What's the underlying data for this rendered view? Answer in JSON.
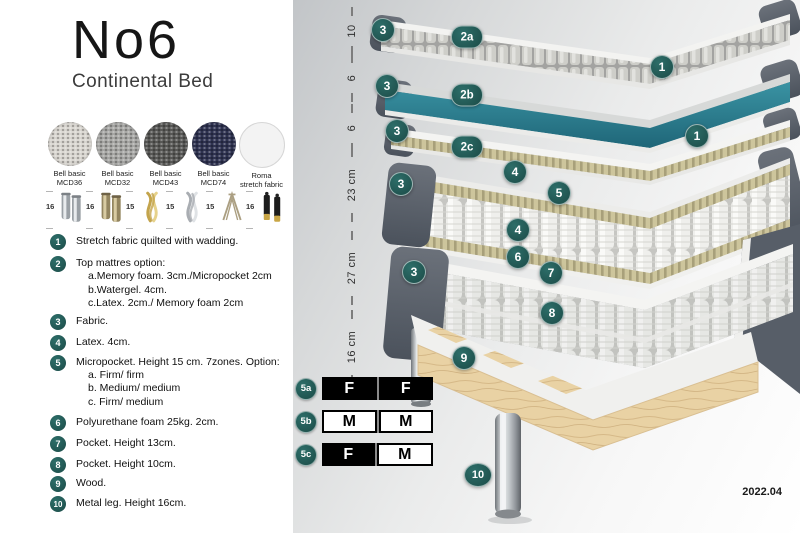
{
  "header": {
    "title": "No6",
    "subtitle": "Continental Bed"
  },
  "fabrics": [
    {
      "line1": "Bell basic",
      "line2": "MCD36",
      "color": "#d9d6d0",
      "texture": true
    },
    {
      "line1": "Bell basic",
      "line2": "MCD32",
      "color": "#a6a6a4",
      "texture": true
    },
    {
      "line1": "Bell basic",
      "line2": "MCD43",
      "color": "#585856",
      "texture": true
    },
    {
      "line1": "Bell basic",
      "line2": "MCD74",
      "color": "#2e3250",
      "texture": true
    },
    {
      "line1": "Roma",
      "line2": "stretch fabric",
      "color": "#f3f3f3",
      "texture": false
    }
  ],
  "legs": [
    {
      "size": "16",
      "icon": "cylinder-silver-leg"
    },
    {
      "size": "16",
      "icon": "cylinder-bronze-leg"
    },
    {
      "size": "15",
      "icon": "twisted-gold-leg"
    },
    {
      "size": "15",
      "icon": "twisted-silver-leg"
    },
    {
      "size": "15",
      "icon": "hairpin-leg"
    },
    {
      "size": "16",
      "icon": "black-gold-leg"
    }
  ],
  "features": [
    {
      "num": "1",
      "text": "Stretch fabric quilted with wadding.",
      "subs": []
    },
    {
      "num": "2",
      "text": "Top mattres option:",
      "subs": [
        "a.Memory foam. 3cm./Micropocket 2cm",
        "b.Watergel. 4cm.",
        "c.Latex. 2cm./ Memory foam 2cm"
      ]
    },
    {
      "num": "3",
      "text": "Fabric.",
      "subs": []
    },
    {
      "num": "4",
      "text": "Latex. 4cm.",
      "subs": []
    },
    {
      "num": "5",
      "text": "Micropocket. Height 15 cm. 7zones. Option:",
      "subs": [
        "a. Firm/ firm",
        "b. Medium/ medium",
        "c. Firm/ medium"
      ]
    },
    {
      "num": "6",
      "text": "Polyurethane foam 25kg. 2cm.",
      "subs": []
    },
    {
      "num": "7",
      "text": "Pocket. Height 13cm.",
      "subs": []
    },
    {
      "num": "8",
      "text": "Pocket. Height 10cm.",
      "subs": []
    },
    {
      "num": "9",
      "text": "Wood.",
      "subs": []
    },
    {
      "num": "10",
      "text": "Metal leg. Height 16cm.",
      "subs": []
    }
  ],
  "diagram": {
    "ruler": [
      {
        "label": "10",
        "y": 31
      },
      {
        "label": "6",
        "y": 78
      },
      {
        "label": "6",
        "y": 128
      },
      {
        "label": "23 cm",
        "y": 185
      },
      {
        "label": "27 cm",
        "y": 268
      },
      {
        "label": "16 cm",
        "y": 347
      }
    ],
    "badges": [
      {
        "label": "3",
        "x": 383,
        "y": 30
      },
      {
        "label": "2a",
        "x": 467,
        "y": 37
      },
      {
        "label": "1",
        "x": 662,
        "y": 67
      },
      {
        "label": "3",
        "x": 387,
        "y": 86
      },
      {
        "label": "2b",
        "x": 467,
        "y": 95
      },
      {
        "label": "3",
        "x": 397,
        "y": 131
      },
      {
        "label": "2c",
        "x": 467,
        "y": 147
      },
      {
        "label": "1",
        "x": 697,
        "y": 136
      },
      {
        "label": "4",
        "x": 515,
        "y": 172
      },
      {
        "label": "5",
        "x": 559,
        "y": 193
      },
      {
        "label": "3",
        "x": 401,
        "y": 184
      },
      {
        "label": "4",
        "x": 518,
        "y": 230
      },
      {
        "label": "6",
        "x": 518,
        "y": 257
      },
      {
        "label": "7",
        "x": 551,
        "y": 273
      },
      {
        "label": "8",
        "x": 552,
        "y": 313
      },
      {
        "label": "3",
        "x": 414,
        "y": 272
      },
      {
        "label": "9",
        "x": 464,
        "y": 358
      },
      {
        "label": "10",
        "x": 478,
        "y": 475
      }
    ],
    "firmness": [
      {
        "label": "5a",
        "cells": [
          {
            "value": "F",
            "style": "dark"
          },
          {
            "value": "F",
            "style": "dark"
          }
        ]
      },
      {
        "label": "5b",
        "cells": [
          {
            "value": "M",
            "style": "light"
          },
          {
            "value": "M",
            "style": "light"
          }
        ]
      },
      {
        "label": "5c",
        "cells": [
          {
            "value": "F",
            "style": "dark"
          },
          {
            "value": "M",
            "style": "light"
          }
        ]
      }
    ],
    "version": "2022.04"
  },
  "colors": {
    "badge_teal": "#2d6e69",
    "badge_teal_dark": "#1f524e",
    "watergel_teal_light": "#3a93a3",
    "watergel_teal_dark": "#1f6678",
    "frame_dark_gray": "#565c66"
  }
}
